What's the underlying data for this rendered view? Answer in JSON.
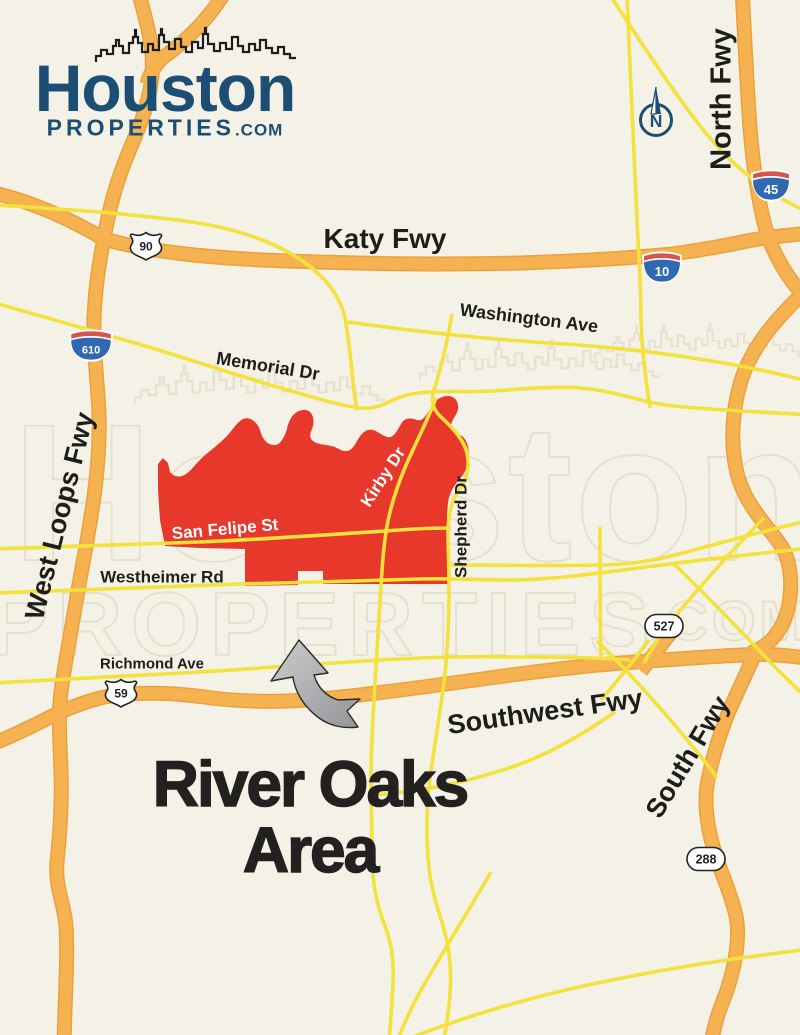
{
  "logo": {
    "brand": "Houston",
    "brand2": "PROPERTIES",
    "tld": ".COM"
  },
  "watermark": {
    "word1": "Houston",
    "word2": "PROPERTIES",
    "tld": ".COM"
  },
  "title": {
    "line1": "River Oaks",
    "line2": "Area"
  },
  "compass": {
    "label": "N"
  },
  "road_labels": {
    "katy": "Katy Fwy",
    "north": "North Fwy",
    "washington": "Washington Ave",
    "memorial": "Memorial Dr",
    "west_loop": "West Loops Fwy",
    "san_felipe": "San Felipe St",
    "kirby": "Kirby Dr",
    "shepherd": "Shepherd Dr",
    "westheimer": "Westheimer Rd",
    "richmond": "Richmond Ave",
    "southwest": "Southwest Fwy",
    "south": "South Fwy"
  },
  "shields": {
    "i45": "45",
    "i10": "10",
    "i610": "610",
    "us90": "90",
    "us59": "59",
    "spur527": "527",
    "sh288": "288"
  },
  "colors": {
    "bg": "#F4F1E6",
    "freeway": "#F6B150",
    "freeway-edge": "#E9A23B",
    "road": "#F2E23B",
    "region": "#E8382B",
    "navy": "#1C4E74",
    "ink": "#1D1D1B",
    "title-ink": "#232020",
    "watermark": "#D9D4C1",
    "shield-blue": "#3069B2",
    "shield-red": "#D95348",
    "arrow-light": "#C9CACC",
    "arrow-dark": "#95979A"
  }
}
